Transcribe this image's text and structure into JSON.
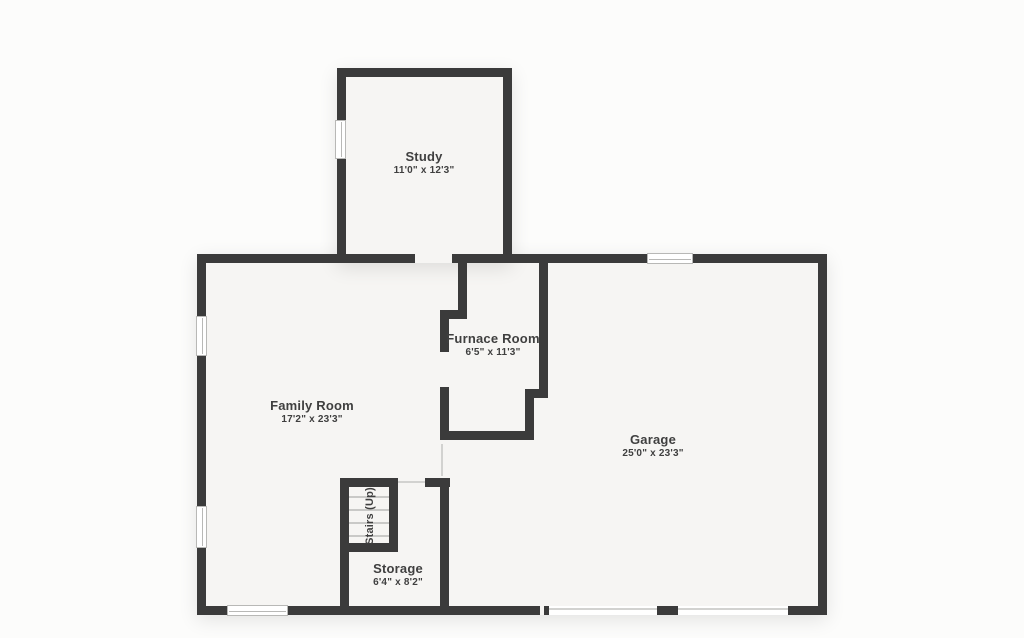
{
  "page": {
    "type": "floor-plan"
  },
  "colors": {
    "wall": "#3b3b3b",
    "floor": "#f6f5f3",
    "background": "#fcfcfb",
    "text": "#3f3f3f",
    "window_border": "#b8b8b6",
    "tread_line": "#c9c9c7",
    "door_line": "#d2d2d0"
  },
  "rooms": {
    "study": {
      "name": "Study",
      "dimensions": "11'0\" x 12'3\""
    },
    "family_room": {
      "name": "Family Room",
      "dimensions": "17'2\" x 23'3\""
    },
    "furnace_room": {
      "name": "Furnace Room",
      "dimensions": "6'5\" x 11'3\""
    },
    "garage": {
      "name": "Garage",
      "dimensions": "25'0\" x 23'3\""
    },
    "storage": {
      "name": "Storage",
      "dimensions": "6'4\" x 8'2\""
    },
    "stairs": {
      "name": "Stairs (Up)"
    }
  }
}
